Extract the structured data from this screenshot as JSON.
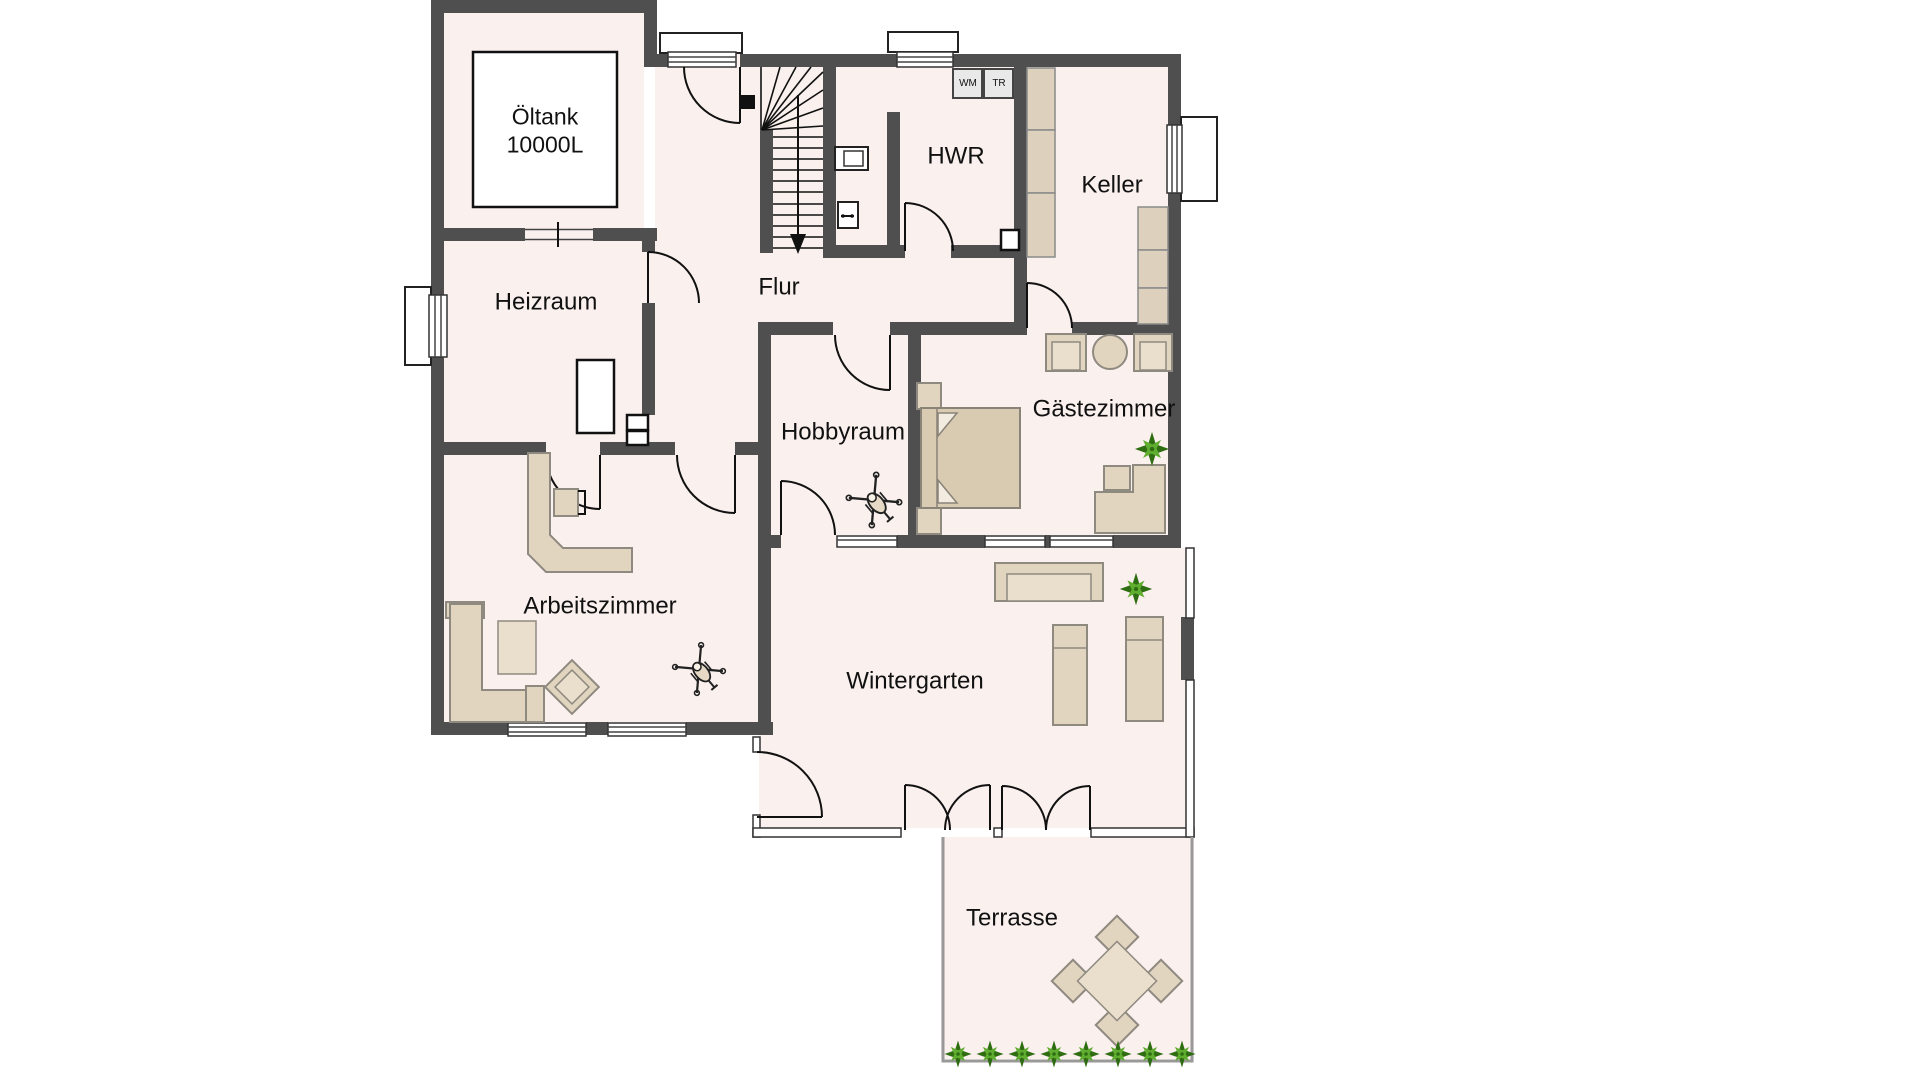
{
  "meta": {
    "document_type": "floor-plan",
    "language": "de",
    "floor": "basement"
  },
  "colors": {
    "background": "#ffffff",
    "room_fill": "#faf0ee",
    "wall": "#4f4f4f",
    "furniture_fill": "#e2d5c0",
    "furniture_fill_light": "#eadfcc",
    "furniture_stroke": "#8f8a80",
    "bed_fill": "#d9cab2",
    "shelf_fill": "#ddd0bd",
    "appliance_fill": "#e9e9e9",
    "plant_dark": "#2f6d13",
    "plant_light": "#5fae2f",
    "glass_line": "#999999",
    "line": "#111111"
  },
  "labels": {
    "oeltank_line1": "Öltank",
    "oeltank_line2": "10000L",
    "heizraum": "Heizraum",
    "flur": "Flur",
    "hwr": "HWR",
    "keller": "Keller",
    "hobbyraum": "Hobbyraum",
    "gaestezimmer": "Gästezimmer",
    "arbeitszimmer": "Arbeitszimmer",
    "wintergarten": "Wintergarten",
    "terrasse": "Terrasse",
    "wm": "WM",
    "tr": "TR"
  },
  "rooms": [
    {
      "id": "oeltank-raum",
      "label": "Öltank 10000L"
    },
    {
      "id": "heizraum",
      "label": "Heizraum"
    },
    {
      "id": "flur",
      "label": "Flur"
    },
    {
      "id": "hwr",
      "label": "HWR"
    },
    {
      "id": "keller",
      "label": "Keller"
    },
    {
      "id": "hobbyraum",
      "label": "Hobbyraum"
    },
    {
      "id": "gaestezimmer",
      "label": "Gästezimmer"
    },
    {
      "id": "arbeitszimmer",
      "label": "Arbeitszimmer"
    },
    {
      "id": "wintergarten",
      "label": "Wintergarten"
    },
    {
      "id": "terrasse",
      "label": "Terrasse"
    }
  ],
  "icons": {
    "plant-icon": "green starburst houseplant",
    "rc-helicopter-icon": "toy helicopter top view",
    "stairs-arrow-icon": "arrow pointing down the stair run",
    "washbasin-icon": "wall mounted basin",
    "washing-machine-box": "WM",
    "dryer-box": "TR"
  }
}
